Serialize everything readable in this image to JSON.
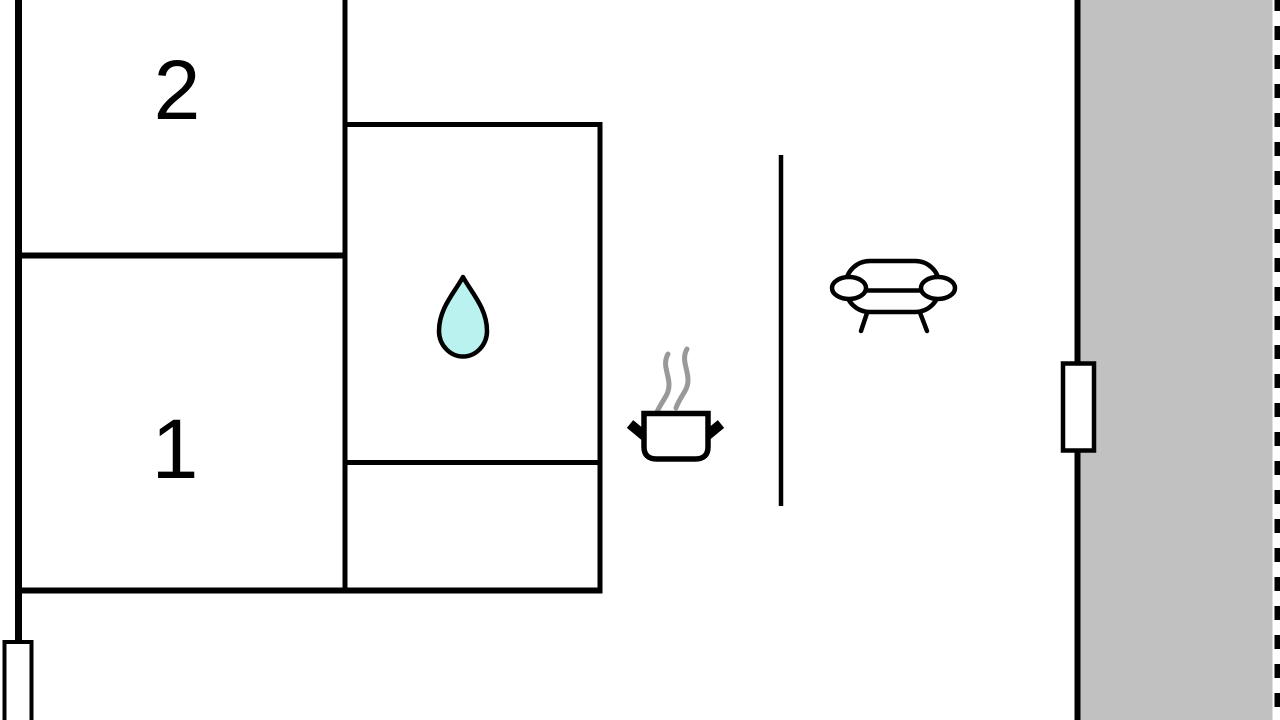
{
  "plan": {
    "type": "apartment-floor-plan",
    "rooms": [
      {
        "label": "2"
      },
      {
        "label": "1"
      }
    ],
    "icons": {
      "bathroom": "water-drop-icon",
      "kitchen": "cooking-pot-icon",
      "kitchen_steam": "steam-icon",
      "living_area": "sofa-icon",
      "right_wall": "window-icon",
      "bottom_left_wall": "window-icon"
    }
  },
  "palette": {
    "wall": "#000000",
    "floor": "#ffffff",
    "terrace_fill": "#c1c1c1",
    "droplet_fill": "#b9f2ef",
    "steam": "#999999",
    "icon_stroke": "#000000"
  }
}
